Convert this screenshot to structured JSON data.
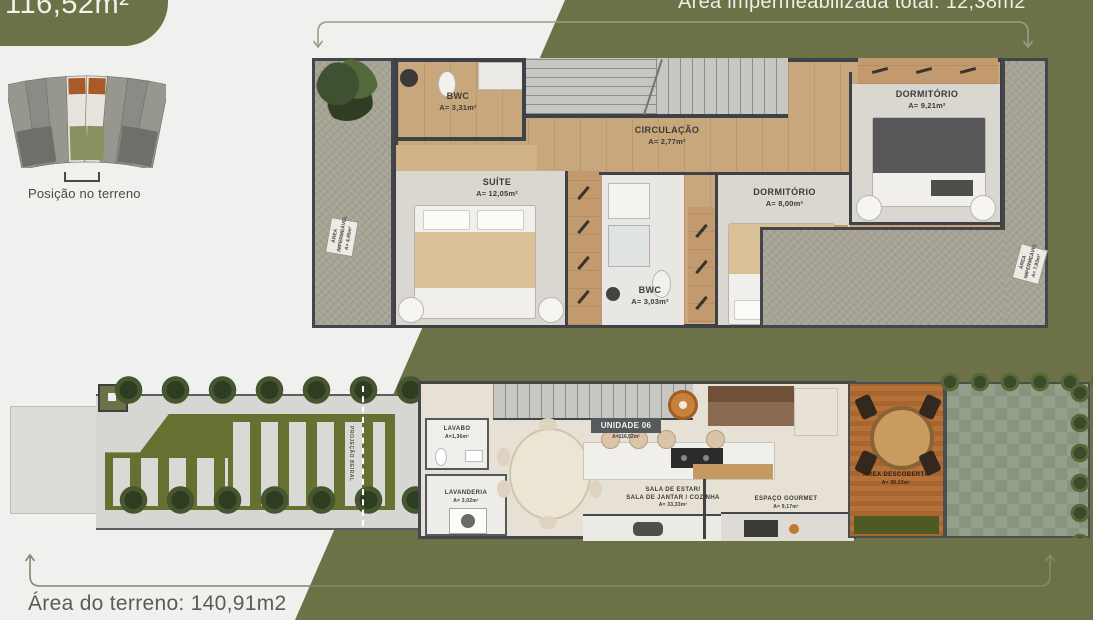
{
  "page": {
    "bg": "#f0f0ee",
    "accent_olive": "#6d7148"
  },
  "badge": {
    "area_label": "116,52m²"
  },
  "top_annotation": {
    "text": "Área impermeabilizada total: 12,38m2"
  },
  "site_plan": {
    "caption": "Posição no terreno"
  },
  "upper_floor": {
    "bwc_top": {
      "name": "BWC",
      "area": "A= 3,31m²"
    },
    "circulacao": {
      "name": "CIRCULAÇÃO",
      "area": "A= 2,77m²"
    },
    "suite": {
      "name": "SUÍTE",
      "area": "A= 12,05m²"
    },
    "dormitorio_right": {
      "name": "DORMITÓRIO",
      "area": "A= 9,21m²"
    },
    "dormitorio_mid": {
      "name": "DORMITÓRIO",
      "area": "A= 8,00m²"
    },
    "bwc_bottom": {
      "name": "BWC",
      "area": "A= 3,03m²"
    },
    "area_impermeavel_left": {
      "name": "ÁREA IMPERMEÁVEL",
      "area": "A= 4,45m²"
    },
    "area_impermeavel_right": {
      "name": "ÁREA IMPERMEÁVEL",
      "area": "A= 7,93m²"
    }
  },
  "ground_floor": {
    "unidade": {
      "name": "UNIDADE 06",
      "area": "A=116,52m²"
    },
    "lavabo": {
      "name": "LAVABO",
      "area": "A=1,36m²"
    },
    "lavanderia": {
      "name": "LAVANDERIA",
      "area": "A= 3,02m²"
    },
    "sala": {
      "line1": "SALA DE ESTAR/",
      "line2": "SALA DE JANTAR / COZINHA",
      "area": "A= 33,33m²"
    },
    "espaco_gourmet": {
      "name": "ESPAÇO GOURMET",
      "area": "A= 9,17m²"
    },
    "area_descoberta": {
      "name": "ÁREA DESCOBERTA",
      "area": "A= 36,13m²"
    },
    "projecao": {
      "text": "PROJEÇÃO BEIRAL"
    }
  },
  "footer": {
    "area_terreno": "Área do terreno: 140,91m2"
  }
}
